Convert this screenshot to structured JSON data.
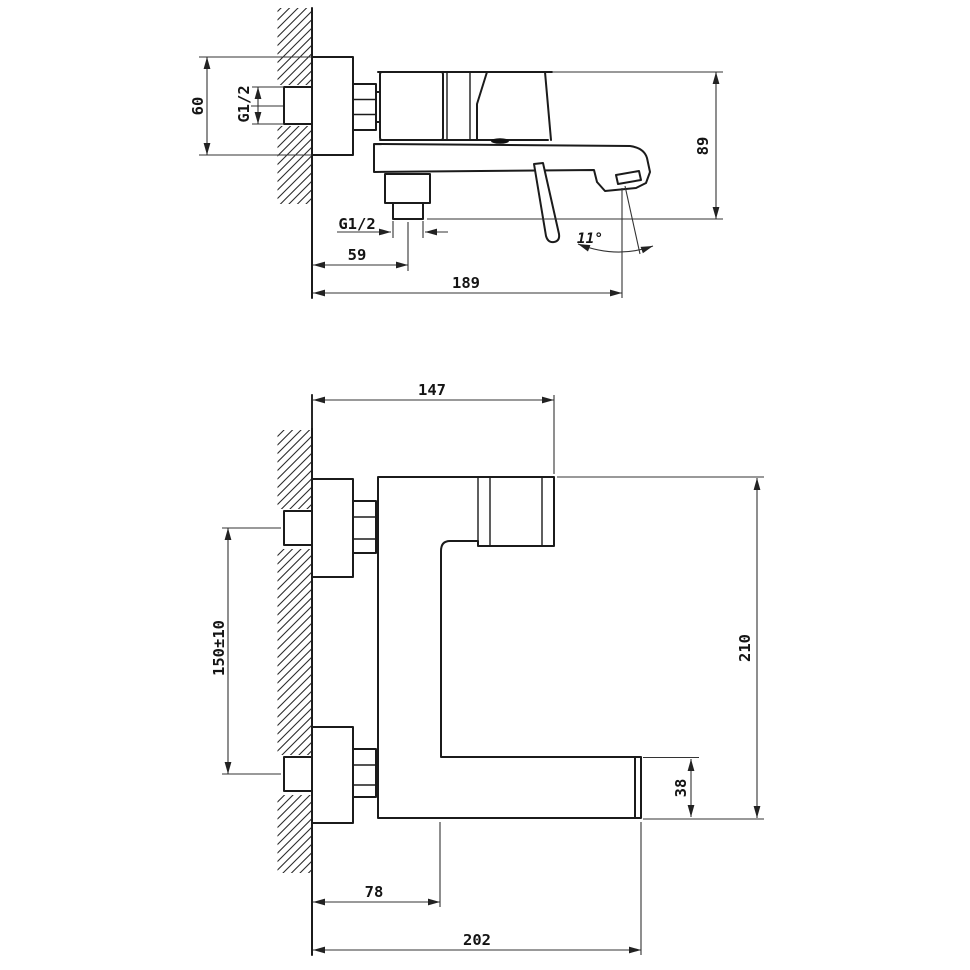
{
  "drawing": {
    "type": "technical-dimension-drawing",
    "subject": "wall-mounted single-lever bath mixer faucet",
    "background_color": "#ffffff",
    "line_color": "#1b1b1b",
    "side_view": {
      "name": "side profile view",
      "dims": {
        "escutcheon_height": "60",
        "inlet_thread": "G1/2",
        "overall_height": "89",
        "outlet_thread": "G1/2",
        "outlet_offset_from_wall": "59",
        "spout_reach": "189",
        "stream_angle": "11°"
      }
    },
    "front_view": {
      "name": "plan view",
      "dims": {
        "handle_reach": "147",
        "inlet_spacing": "150±10",
        "overall_length": "210",
        "spout_end_width": "38",
        "body_offset": "78",
        "spout_reach": "202"
      }
    }
  }
}
